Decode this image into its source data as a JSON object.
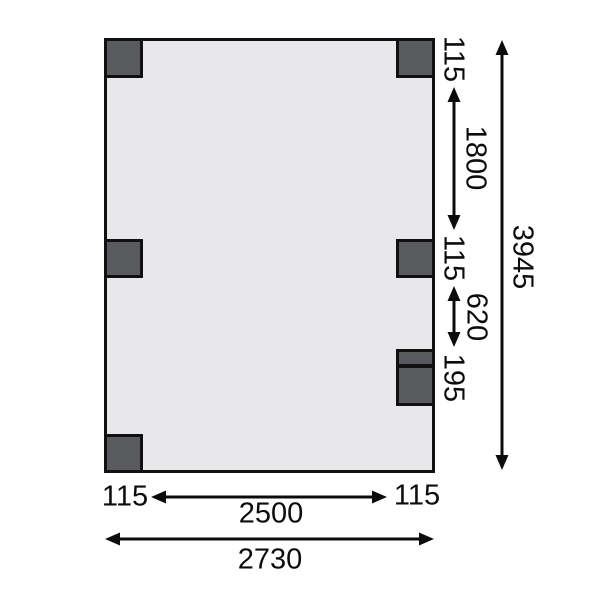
{
  "diagram": {
    "type": "dimensioned floor plan with posts",
    "colors": {
      "background": "#ffffff",
      "plan_fill": "#e8e8ea",
      "post_fill": "#595a5e",
      "line": "#111111"
    },
    "dims": {
      "post_top": "115",
      "bay_upper": "1800",
      "post_mid": "115",
      "bay_lower": "620",
      "post_double": "195",
      "total_depth": "3945",
      "offset_left": "115",
      "span_inner": "2500",
      "offset_right": "115",
      "total_width": "2730"
    }
  }
}
